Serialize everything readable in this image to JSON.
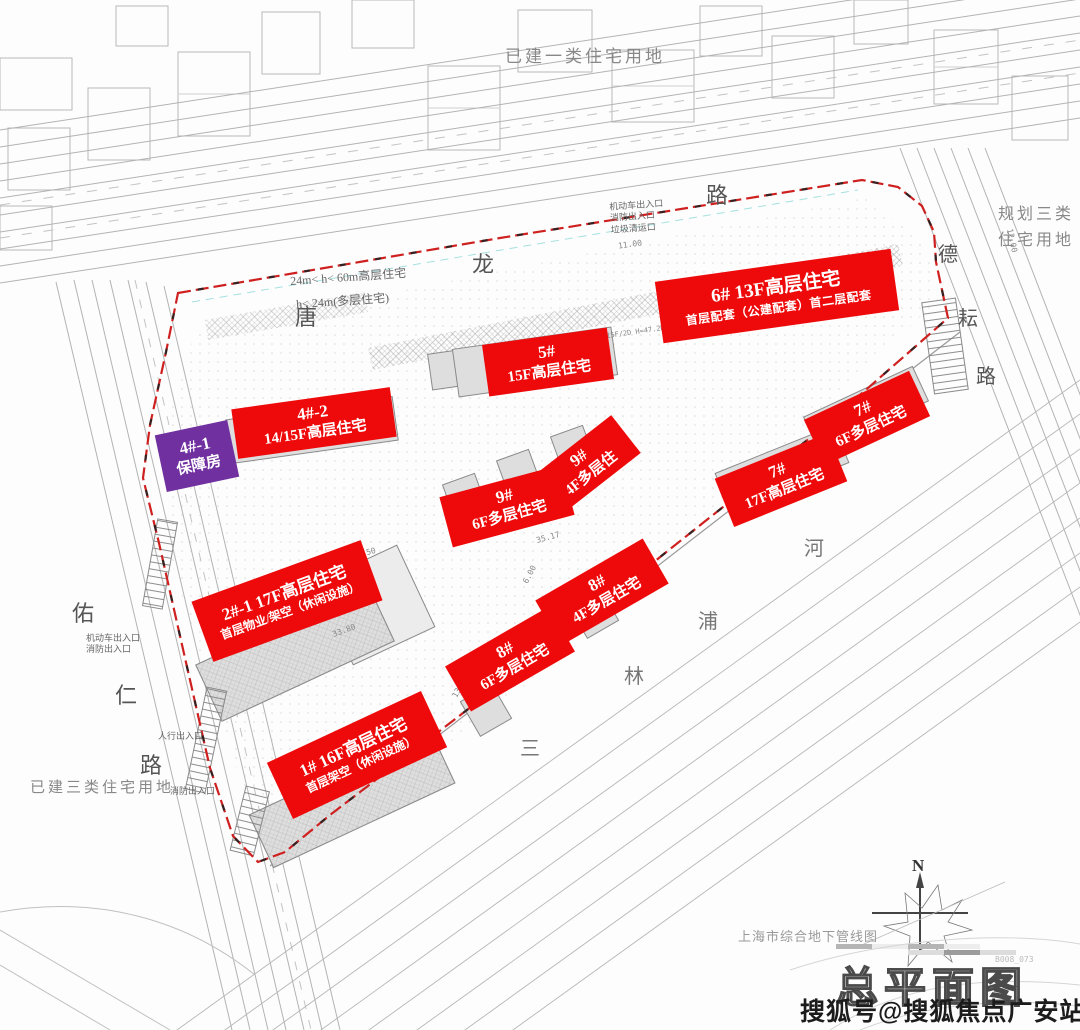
{
  "page": {
    "title": "总平面图",
    "watermark": "搜狐号@搜狐焦点广安站",
    "sheet_note": "B008_073"
  },
  "colors": {
    "label_red": "#ee0a0a",
    "label_purple": "#7030a0",
    "boundary_red": "#cf2020"
  },
  "land_use": {
    "top": "已建一类住宅用地",
    "right_line1": "规划三类",
    "right_line2": "住宅用地",
    "bottom_left": "已建三类住宅用地"
  },
  "roads": {
    "tanglong": [
      "唐",
      "龙",
      "路"
    ],
    "youren": [
      "佑",
      "仁",
      "路"
    ],
    "deyun": [
      "德",
      "耘",
      "路"
    ],
    "river": [
      "三",
      "林",
      "浦",
      "河"
    ]
  },
  "height_notes": {
    "rule1": "24m< h< 60m高层住宅",
    "rule2": "h< 24m(多层住宅)"
  },
  "entrances": {
    "top": [
      "机动车出入口",
      "消防出入口",
      "垃圾清运口"
    ],
    "left": [
      "机动车出入口",
      "消防出入口"
    ],
    "pedestrian": "人行出入口",
    "fire_sw": "消防出入口"
  },
  "notes": {
    "pipeline": "上海市综合地下管线图",
    "north": "N",
    "unit_tag": "15F/2D H=47.2M"
  },
  "buildings": [
    {
      "line1": "1# 16F高层住宅",
      "line2": "首层架空（休闲设施）"
    },
    {
      "line1": "2#-1 17F高层住宅",
      "line2": "首层物业/架空（休闲设施）"
    },
    {
      "line1": "4#-1",
      "line2": "保障房"
    },
    {
      "line1": "4#-2",
      "line2": "14/15F高层住宅"
    },
    {
      "line1": "5#",
      "line2": "15F高层住宅"
    },
    {
      "line1": "6# 13F高层住宅",
      "line2": "首层配套（公建配套）首二层配套"
    },
    {
      "line1": "7#",
      "line2": "17F高层住宅"
    },
    {
      "line1": "7#",
      "line2": "6F多层住宅"
    },
    {
      "line1": "8#",
      "line2": "4F多层住宅"
    },
    {
      "line1": "8#",
      "line2": "6F多层住宅"
    },
    {
      "line1": "9#",
      "line2": "4F多层住"
    },
    {
      "line1": "9#",
      "line2": "6F多层住宅"
    }
  ],
  "dimensions": [
    "33.80",
    "18.50",
    "35.17",
    "6.00",
    "13.55",
    "11.00",
    "12.00",
    "4.30"
  ]
}
